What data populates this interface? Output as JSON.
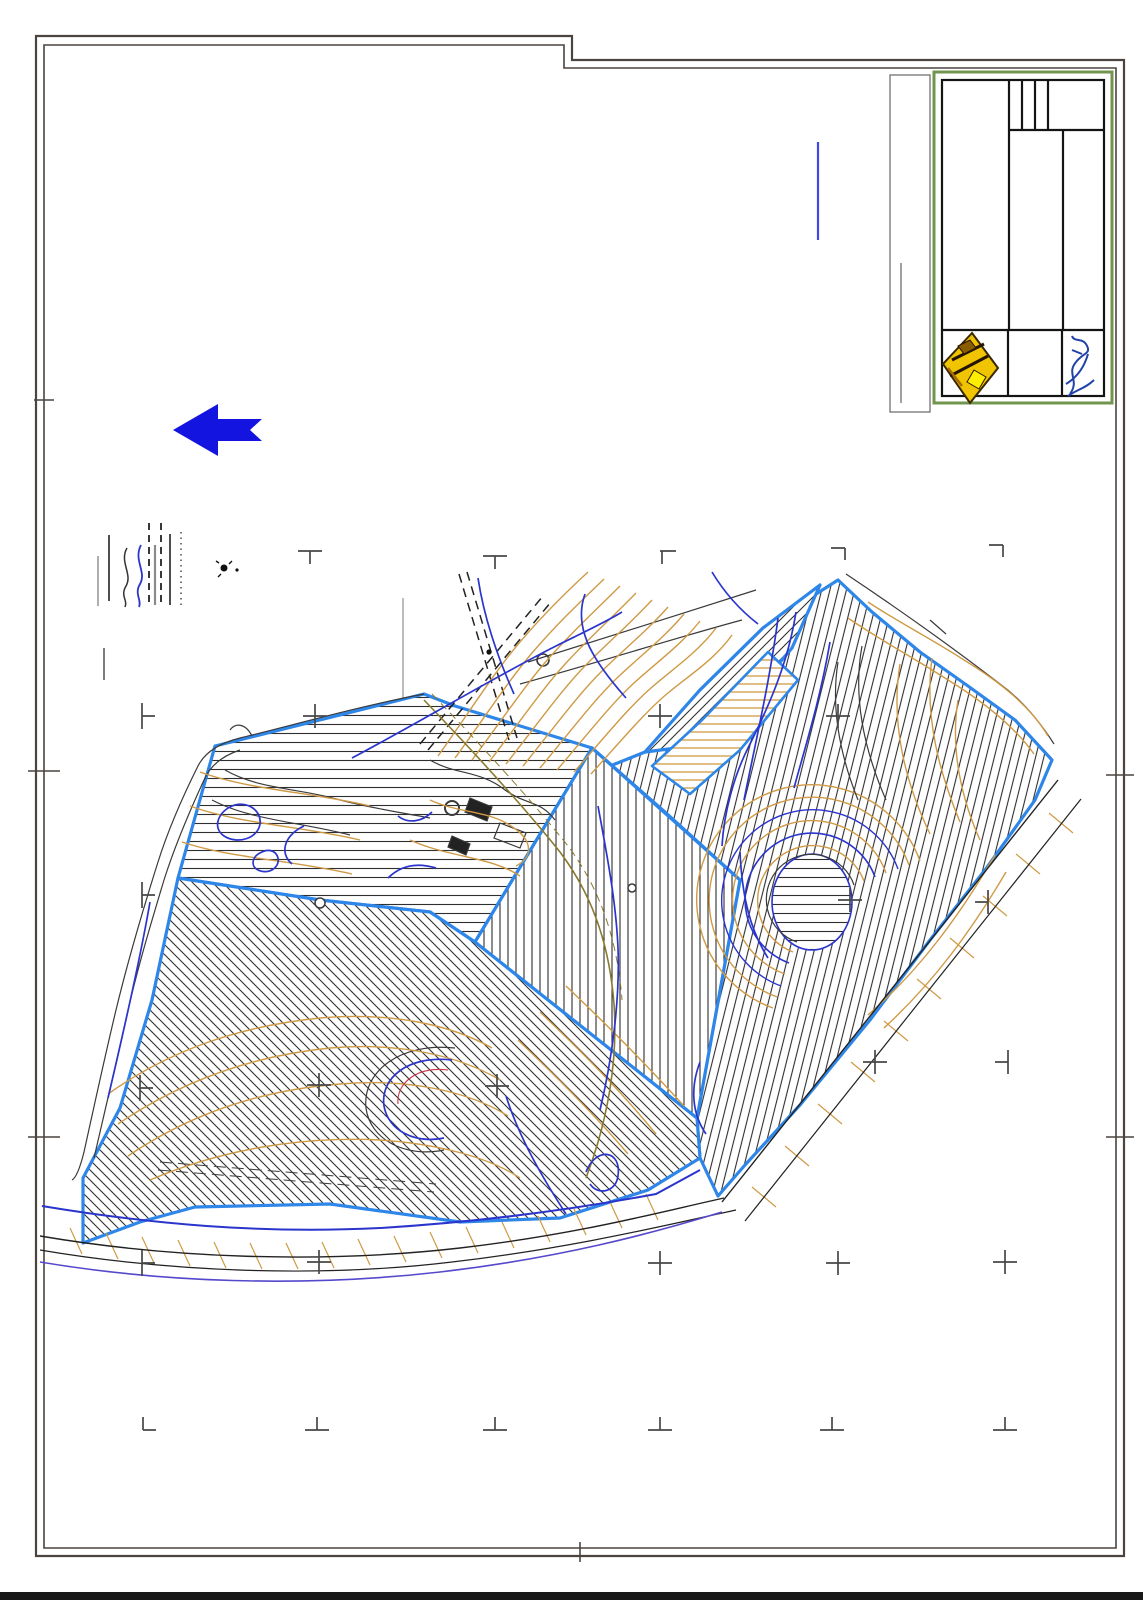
{
  "sheet": {
    "kind": "scanned CAD site-plan sheet",
    "background": "#ffffff",
    "frame_color": "#4b443f",
    "bottom_bar_color": "#181818"
  },
  "title_block": {
    "border_color": "#71944e",
    "grid_color": "#141414",
    "logo": {
      "name": "surveyor-emblem-logo",
      "primary_color": "#f0c400",
      "accent_color": "#ffee00",
      "outline_color": "#3a2800"
    },
    "signature": {
      "name": "approval-signature",
      "ink_color": "#2143a8"
    }
  },
  "north_arrow": {
    "color": "#1414e0",
    "direction": "left"
  },
  "reference_line_color": "#4146e8",
  "legend": {
    "items": [
      {
        "name": "thin-gray-line"
      },
      {
        "name": "black-solid-line"
      },
      {
        "name": "terrain-wavy-line"
      },
      {
        "name": "stream-wavy-line"
      },
      {
        "name": "track-dashed-line"
      },
      {
        "name": "gray-wide-line"
      },
      {
        "name": "track-dashed-line-2"
      },
      {
        "name": "black-solid-line-2"
      },
      {
        "name": "dotted-line"
      },
      {
        "name": "point-marker"
      }
    ]
  },
  "map": {
    "colors": {
      "parcel_boundary": "#2e86e8",
      "contour": "#cf9a45",
      "stream": "#2b35cc",
      "terrain": "#3a3a3a",
      "track": "#8a7a30",
      "road_secondary": "#5548cc",
      "grid_mark": "#474747"
    },
    "parcels": [
      {
        "name": "parcel-northwest",
        "hatch": "horizontal"
      },
      {
        "name": "parcel-southwest",
        "hatch": "diagonal-down"
      },
      {
        "name": "parcel-central",
        "hatch": "vertical"
      },
      {
        "name": "parcel-east",
        "hatch": "steep-diagonal"
      },
      {
        "name": "parcel-northeast-triangle",
        "hatch": "diagonal-up"
      },
      {
        "name": "parcel-terrace-strip",
        "hatch": "orange-horizontal"
      },
      {
        "name": "parcel-knoll",
        "hatch": "horizontal"
      }
    ]
  }
}
